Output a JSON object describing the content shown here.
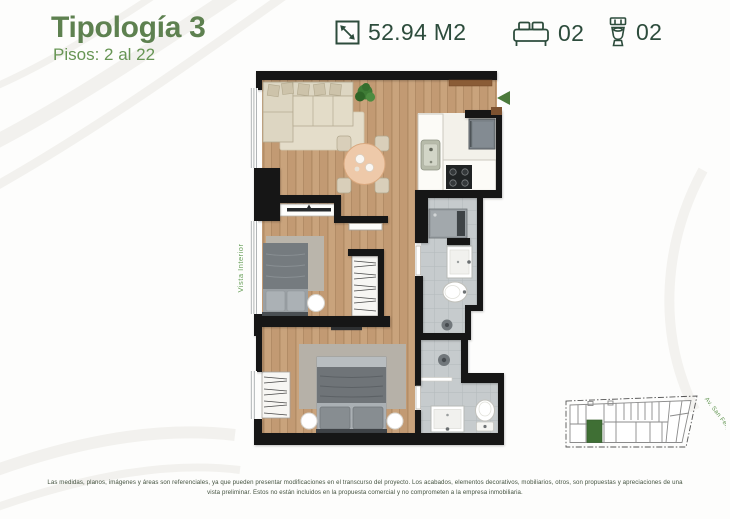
{
  "header": {
    "title": "Tipología 3",
    "subtitle": "Pisos: 2 al 22",
    "specs": {
      "area": {
        "icon": "area-diagonal-arrow-icon",
        "value": "52.94 M2"
      },
      "bedrooms": {
        "icon": "bed-icon",
        "value": "02"
      },
      "bathrooms": {
        "icon": "toilet-icon",
        "value": "02"
      }
    }
  },
  "floorplan": {
    "view_label": "Vista Interior",
    "entry_arrow_color": "#4c7a3b"
  },
  "keyplan": {
    "street_label": "Av. San Felipe",
    "highlighted_unit_color": "#3f6f34"
  },
  "footer": {
    "disclaimer_line1": "Las medidas, planos, imágenes y áreas son referenciales, ya que pueden presentar modificaciones en el transcurso del proyecto. Los acabados, elementos decorativos, mobiliarios, otros, son propuestas y apreciaciones de una",
    "disclaimer_line2": "vista preliminar. Estos no están incluidos en la propuesta comercial y no comprometen a la empresa inmobiliaria."
  },
  "colors": {
    "title_green": "#5e8150",
    "subtitle_green": "#679554",
    "spec_dark_green": "#2d4c3c"
  }
}
